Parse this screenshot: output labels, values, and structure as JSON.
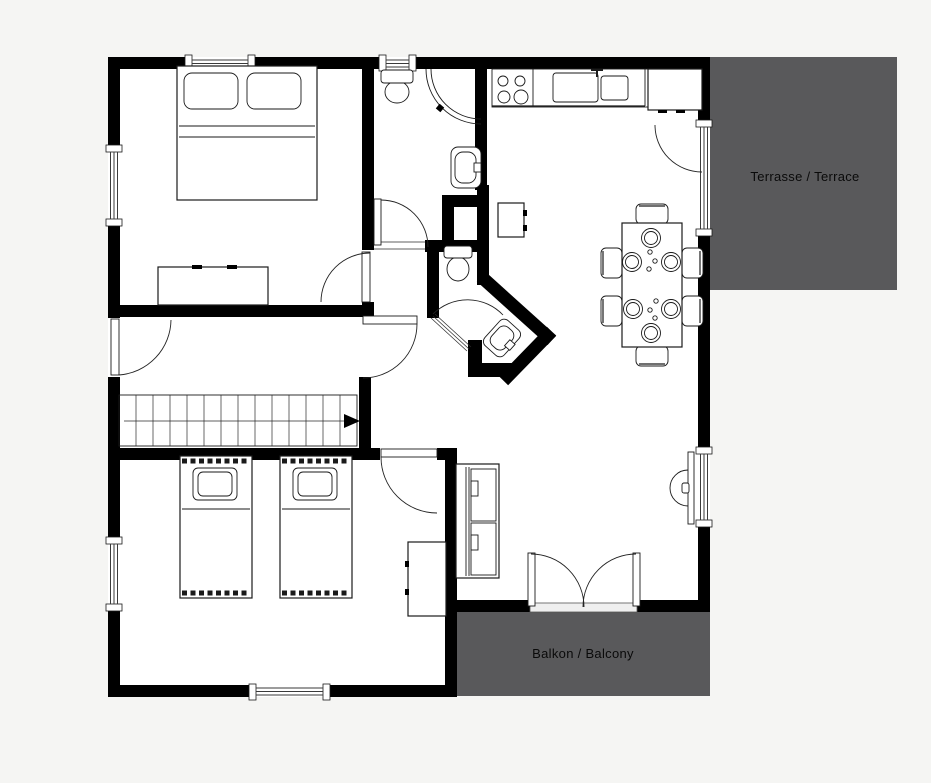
{
  "page": {
    "background": "#f5f5f3"
  },
  "plan": {
    "labels": {
      "terrace": "Terrasse / Terrace",
      "balcony": "Balkon / Balcony"
    },
    "colors": {
      "outdoor_area": "#59595b",
      "wall": "#000000",
      "floor": "#ffffff",
      "label_text": "#0a0a0a",
      "threshold": "#efefef"
    },
    "fixtures": [
      "double-bed",
      "dresser",
      "single-bed",
      "single-bed",
      "wardrobe",
      "stairs-up-arrow",
      "sofa",
      "tv",
      "dining-table",
      "dining-chair",
      "plate",
      "stove",
      "kitchen-sink",
      "fridge",
      "base-cabinet",
      "toilet",
      "corner-shower",
      "washbasin",
      "wc-toilet",
      "wc-washbasin"
    ]
  }
}
